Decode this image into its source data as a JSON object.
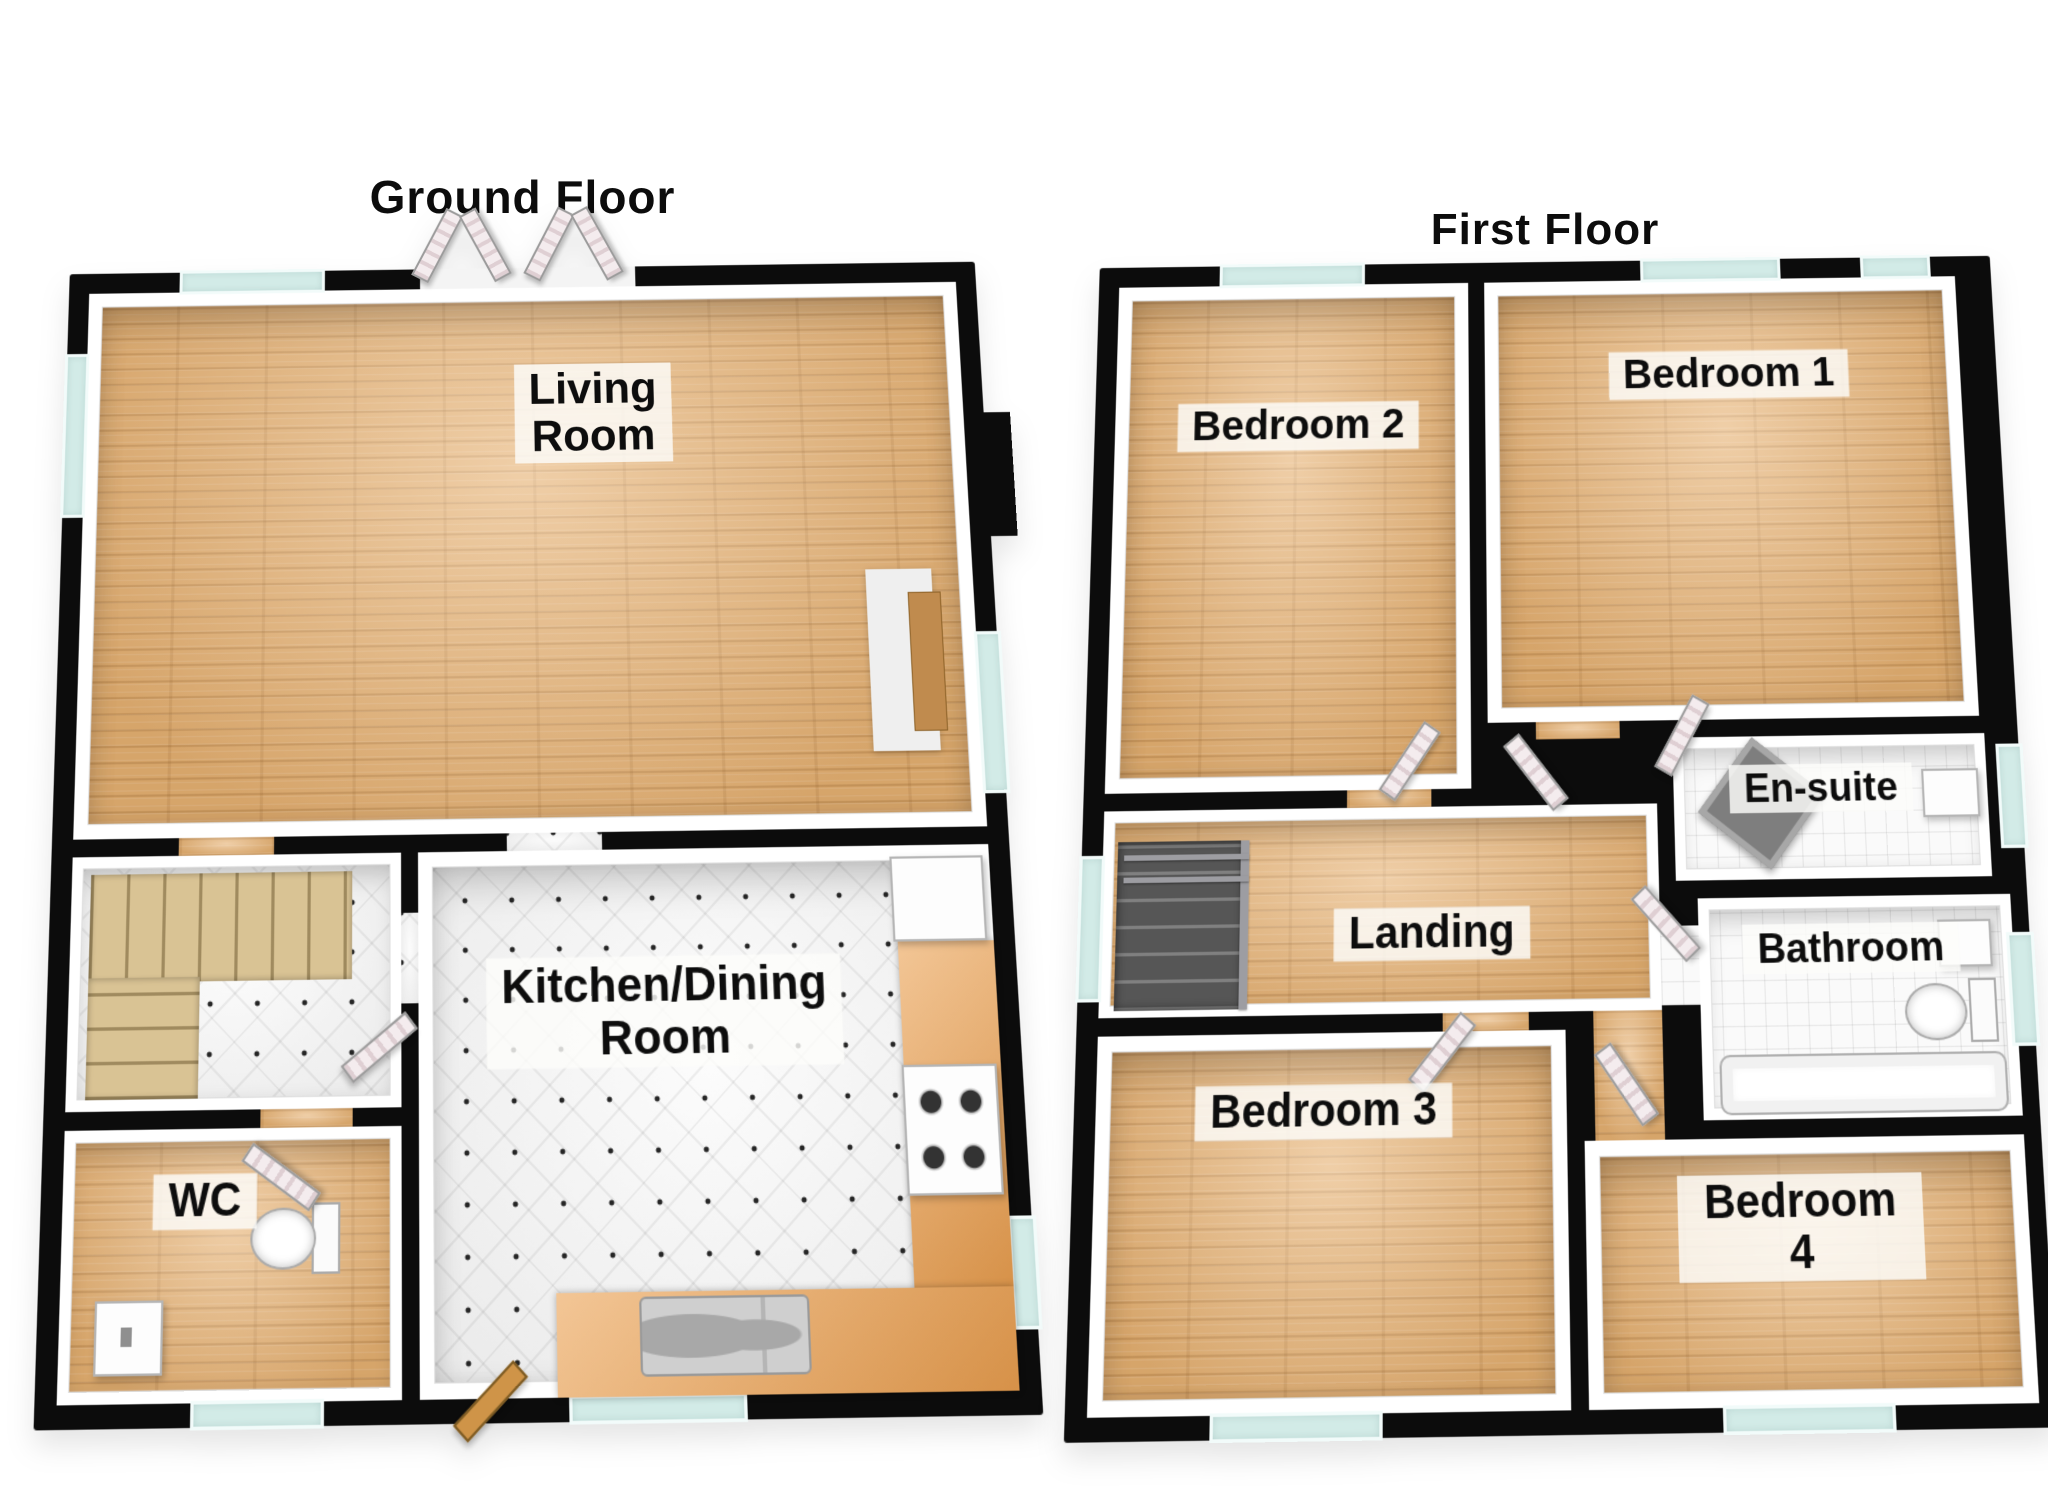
{
  "ground_floor": {
    "title": "Ground Floor",
    "rooms": {
      "living_room": "Living\nRoom",
      "kitchen_dining": "Kitchen/Dining\nRoom",
      "wc": "WC"
    }
  },
  "first_floor": {
    "title": "First Floor",
    "rooms": {
      "bedroom_1": "Bedroom 1",
      "bedroom_2": "Bedroom 2",
      "bedroom_3": "Bedroom 3",
      "bedroom_4": "Bedroom 4",
      "en_suite": "En-suite",
      "bathroom": "Bathroom",
      "landing": "Landing"
    }
  },
  "colors": {
    "wall": "#0c0c0c",
    "wood_floor": "#e6b172",
    "kitchen_tile": "#f5f5f5",
    "bathroom_tile": "#fafafa",
    "window_glass": "#d2ebe7",
    "stairs_wood": "#d9c394",
    "kitchen_counter": "#eca75d",
    "label_background": "#fcfcfa",
    "text": "#0d0d0d",
    "page_background": "#ffffff"
  }
}
